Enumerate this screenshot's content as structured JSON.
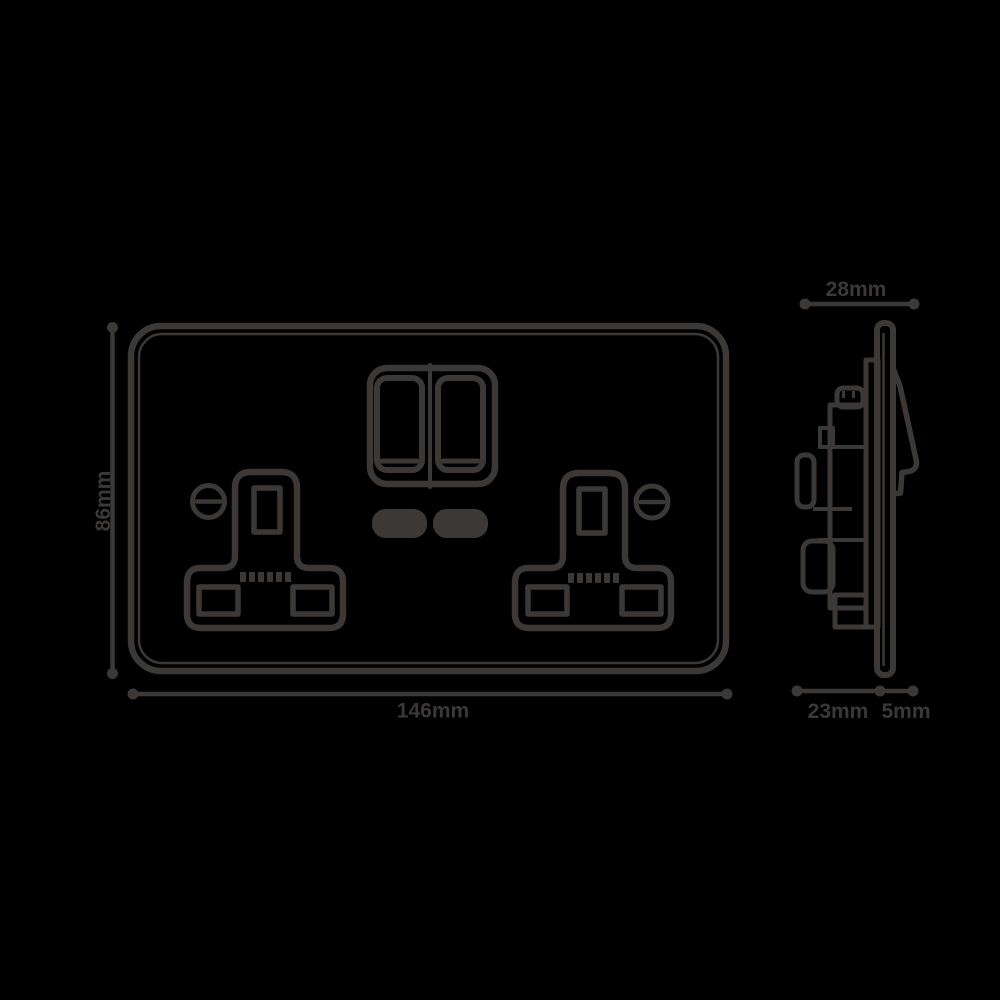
{
  "colors": {
    "background": "#000000",
    "line": "#3c3836"
  },
  "front_view": {
    "width_label": "146mm",
    "height_label": "86mm"
  },
  "side_view": {
    "depth_total_label": "28mm",
    "depth_back_label": "23mm",
    "depth_front_label": "5mm"
  }
}
